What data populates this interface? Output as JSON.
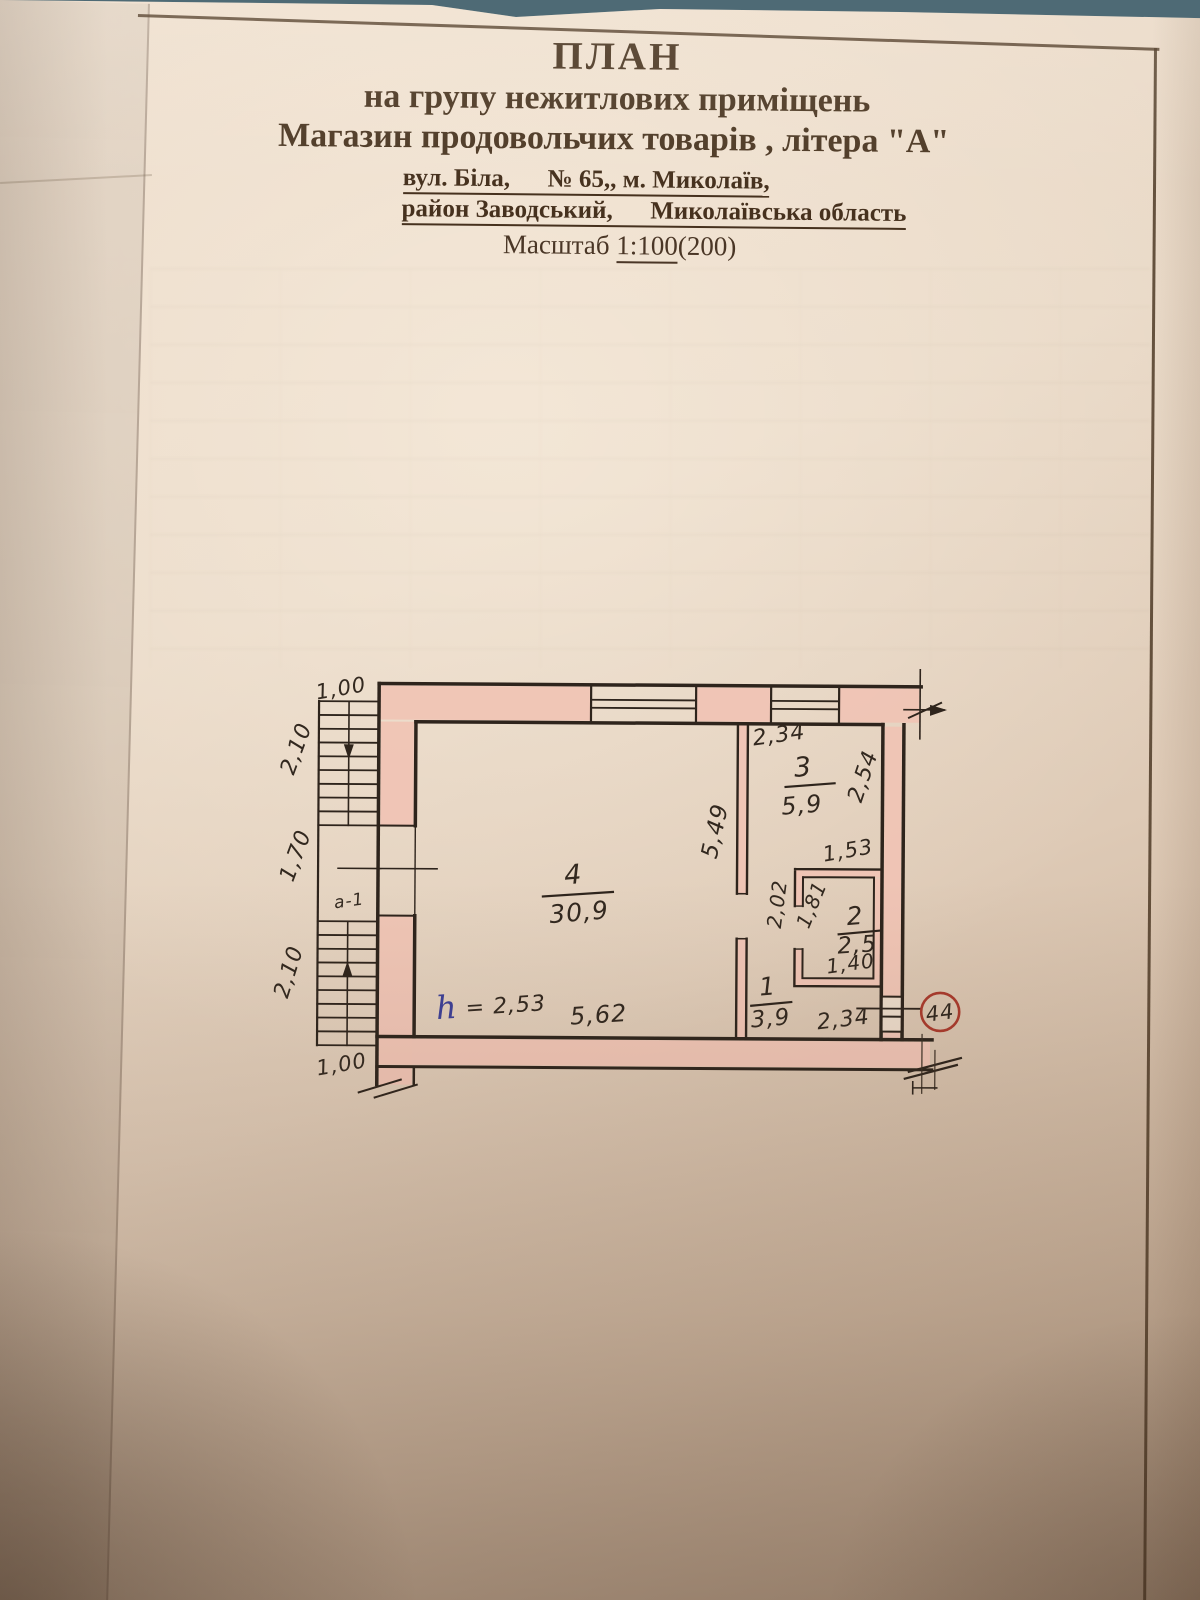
{
  "title_block": {
    "line1": "ПЛАН",
    "line2": "на групу нежитлових приміщень",
    "line3": "Магазин продовольчих товарів , літера \"А\"",
    "address_line1": "вул. Біла,      № 65,, м. Миколаїв,",
    "address_line2": "район Заводський,      Миколаївська область",
    "scale_prefix": "Масштаб ",
    "scale_value": "1:100",
    "scale_suffix": "(200)"
  },
  "plan": {
    "plot_number": "44",
    "stair_flight_label": "а-1",
    "height_note": {
      "symbol": "h",
      "value": "= 2,53"
    },
    "rooms": [
      {
        "number": "1",
        "area": "3,9"
      },
      {
        "number": "2",
        "area": "2,5"
      },
      {
        "number": "3",
        "area": "5,9"
      },
      {
        "number": "4",
        "area": "30,9"
      }
    ],
    "dimensions": {
      "stair_width_top": "1,00",
      "stair_flight_top": "2,10",
      "stair_landing": "1,70",
      "stair_flight_bottom": "2,10",
      "stair_width_bottom": "1,00",
      "room4_depth": "5,49",
      "room4_width": "5,62",
      "room3_width": "2,34",
      "room3_depth": "2,54",
      "room2_width_top": "1,53",
      "room2_side_left": "2,02",
      "room2_inner_depth": "1,81",
      "room2_width_bottom": "1,40",
      "room1_width": "2,34"
    },
    "colors": {
      "wall_fill": "#f0c3b4",
      "ink": "#2e241c",
      "room_number_red": "#c13527",
      "plot_circle_red": "#a83a2c",
      "height_note_blue": "#3c3f96"
    }
  }
}
